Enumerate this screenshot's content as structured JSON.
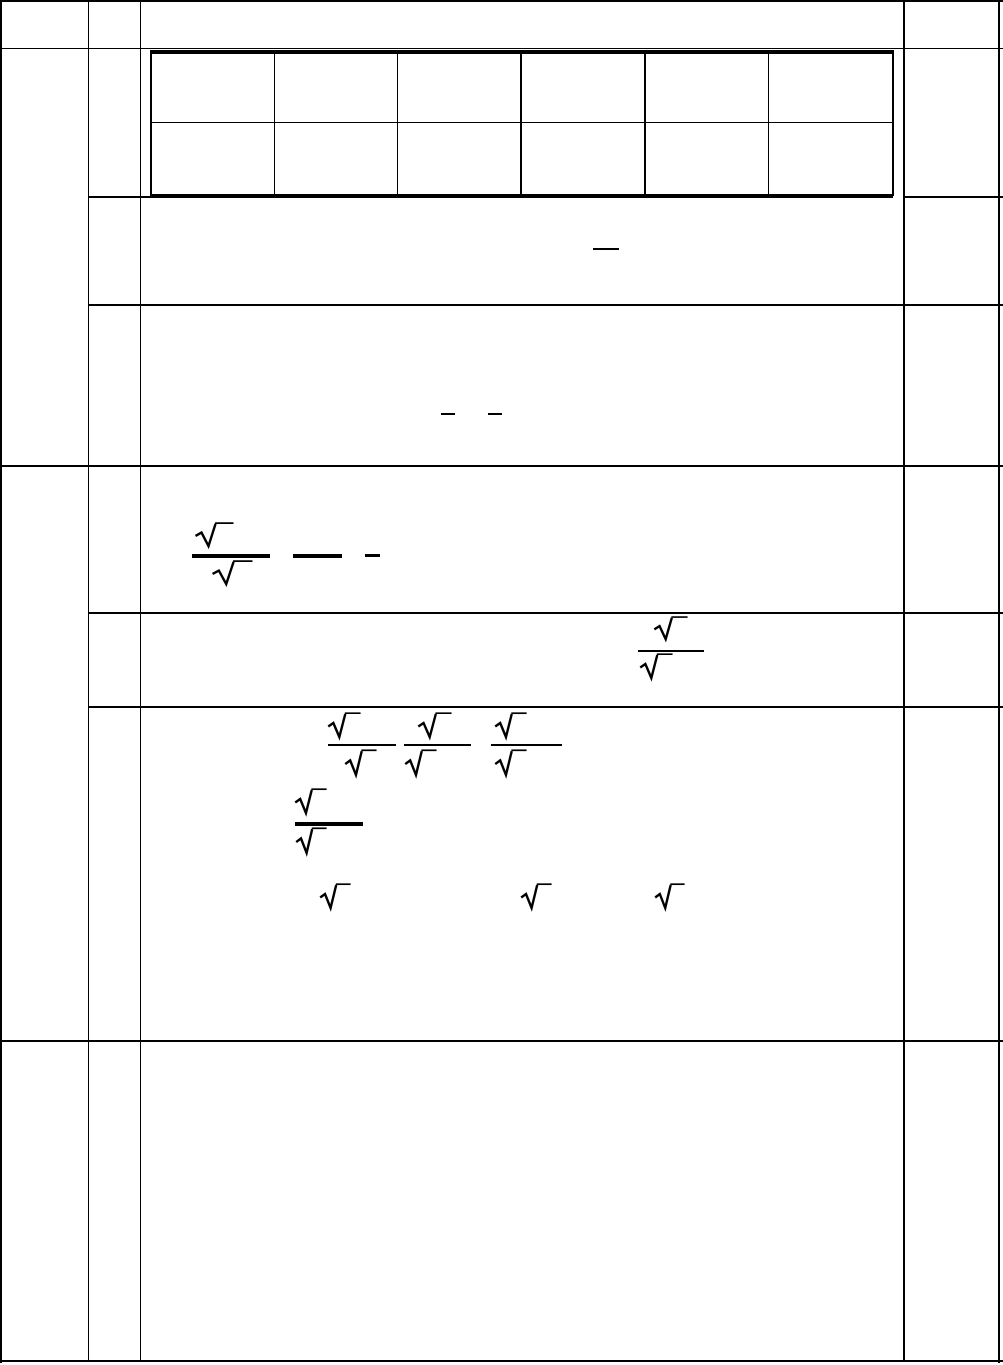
{
  "meta": {
    "description": "scanned blank math worksheet table with stripped symbols",
    "background_color": "#ffffff",
    "ink_color": "#000000",
    "canvas": {
      "width": 1003,
      "height": 1365
    }
  },
  "outer_table": {
    "column_edges_x": [
      0,
      88,
      140,
      904,
      1003
    ],
    "row_edges_y": [
      0,
      47,
      196,
      304,
      465,
      612,
      706,
      1040,
      1363
    ]
  },
  "nested_answer_grid": {
    "x": 150,
    "y": 50,
    "width": 743,
    "height": 147,
    "columns": 6,
    "rows": 2
  },
  "lines": [
    {
      "name": "outer-border-top",
      "x": 0,
      "y": 0,
      "w": 1003,
      "h": 2.2
    },
    {
      "name": "outer-border-bottom",
      "x": 0,
      "y": 1359.5,
      "w": 1003,
      "h": 2.2
    },
    {
      "name": "outer-border-left",
      "x": 0,
      "y": 0,
      "w": 2.2,
      "h": 1363
    },
    {
      "name": "outer-border-right",
      "x": 997.5,
      "y": 0,
      "w": 2.2,
      "h": 1363
    },
    {
      "name": "column-divider-1",
      "x": 87.5,
      "y": 0,
      "w": 1.8,
      "h": 1361
    },
    {
      "name": "column-divider-2",
      "x": 139.5,
      "y": 0,
      "w": 1.8,
      "h": 1361
    },
    {
      "name": "column-divider-3",
      "x": 903,
      "y": 0,
      "w": 1.8,
      "h": 1361
    },
    {
      "name": "row-line-header",
      "x": 0,
      "y": 47.5,
      "w": 1003,
      "h": 1.8
    },
    {
      "name": "row-line-2-left-seg",
      "x": 88,
      "y": 196,
      "w": 63,
      "h": 1.8
    },
    {
      "name": "row-line-2-right-seg",
      "x": 904,
      "y": 196,
      "w": 99,
      "h": 1.8
    },
    {
      "name": "row-line-3",
      "x": 88,
      "y": 304,
      "w": 915,
      "h": 1.8
    },
    {
      "name": "row-line-4",
      "x": 0,
      "y": 465,
      "w": 1003,
      "h": 2
    },
    {
      "name": "row-line-5",
      "x": 88,
      "y": 612,
      "w": 915,
      "h": 1.8
    },
    {
      "name": "row-line-6",
      "x": 88,
      "y": 706,
      "w": 915,
      "h": 1.8
    },
    {
      "name": "row-line-7",
      "x": 0,
      "y": 1040,
      "w": 1003,
      "h": 2
    },
    {
      "name": "nested-grid-border-top",
      "x": 150,
      "y": 50,
      "w": 743,
      "h": 3.5
    },
    {
      "name": "nested-grid-border-bottom",
      "x": 150,
      "y": 194,
      "w": 743,
      "h": 3.5
    },
    {
      "name": "nested-grid-border-left",
      "x": 150,
      "y": 50,
      "w": 2,
      "h": 146
    },
    {
      "name": "nested-grid-border-right",
      "x": 891.5,
      "y": 50,
      "w": 2,
      "h": 146
    },
    {
      "name": "nested-grid-col-line-1",
      "x": 273.5,
      "y": 51,
      "w": 1.8,
      "h": 145
    },
    {
      "name": "nested-grid-col-line-2",
      "x": 396.5,
      "y": 51,
      "w": 1.8,
      "h": 145
    },
    {
      "name": "nested-grid-col-line-3",
      "x": 520,
      "y": 51,
      "w": 1.8,
      "h": 145
    },
    {
      "name": "nested-grid-col-line-4",
      "x": 644,
      "y": 51,
      "w": 1.8,
      "h": 145
    },
    {
      "name": "nested-grid-col-line-5",
      "x": 767.5,
      "y": 51,
      "w": 1.8,
      "h": 145
    },
    {
      "name": "nested-grid-row-line",
      "x": 150,
      "y": 121.5,
      "w": 741.5,
      "h": 1.8
    },
    {
      "name": "fraction-bar-row3",
      "x": 593,
      "y": 247.5,
      "w": 26,
      "h": 2.5
    },
    {
      "name": "minus-dash-row4-a",
      "x": 441,
      "y": 413,
      "w": 14,
      "h": 2
    },
    {
      "name": "minus-dash-row4-b",
      "x": 488,
      "y": 413,
      "w": 14,
      "h": 2
    },
    {
      "name": "fraction-bar-row5",
      "x": 192,
      "y": 554,
      "w": 78,
      "h": 4
    },
    {
      "name": "long-dash-row5",
      "x": 293,
      "y": 554,
      "w": 49,
      "h": 3.5
    },
    {
      "name": "short-dash-row5",
      "x": 365,
      "y": 553.5,
      "w": 15,
      "h": 3
    },
    {
      "name": "fraction-bar-row6",
      "x": 638,
      "y": 649.5,
      "w": 66,
      "h": 2.2
    },
    {
      "name": "fraction-bar-row7-a",
      "x": 328,
      "y": 743.5,
      "w": 68,
      "h": 2.2
    },
    {
      "name": "fraction-bar-row7-b",
      "x": 404,
      "y": 743.5,
      "w": 67,
      "h": 2.2
    },
    {
      "name": "fraction-bar-row7-c",
      "x": 491,
      "y": 743.5,
      "w": 71,
      "h": 2.2
    },
    {
      "name": "fraction-bar-row7-d",
      "x": 295,
      "y": 821.5,
      "w": 68,
      "h": 4
    }
  ],
  "radicals": [
    {
      "name": "radical-row5-numerator",
      "x": 194,
      "y": 521,
      "w": 40,
      "h": 27
    },
    {
      "name": "radical-row5-denominator",
      "x": 211,
      "y": 559,
      "w": 42,
      "h": 27
    },
    {
      "name": "radical-row6-numerator",
      "x": 653,
      "y": 615,
      "w": 35,
      "h": 26
    },
    {
      "name": "radical-row6-denominator",
      "x": 639,
      "y": 652,
      "w": 34,
      "h": 28
    },
    {
      "name": "radical-row7-frac1-numerator",
      "x": 327,
      "y": 711,
      "w": 34,
      "h": 28
    },
    {
      "name": "radical-row7-frac1-denominator",
      "x": 344,
      "y": 748,
      "w": 33,
      "h": 29
    },
    {
      "name": "radical-row7-frac2-numerator",
      "x": 417,
      "y": 711,
      "w": 35,
      "h": 28
    },
    {
      "name": "radical-row7-frac2-denominator",
      "x": 404,
      "y": 748,
      "w": 33,
      "h": 29
    },
    {
      "name": "radical-row7-frac3-numerator",
      "x": 494,
      "y": 711,
      "w": 33,
      "h": 28
    },
    {
      "name": "radical-row7-frac3-denominator",
      "x": 494,
      "y": 748,
      "w": 33,
      "h": 29
    },
    {
      "name": "radical-row7-frac4-numerator",
      "x": 294,
      "y": 787,
      "w": 33,
      "h": 28
    },
    {
      "name": "radical-row7-frac4-denominator",
      "x": 295,
      "y": 826,
      "w": 32,
      "h": 29
    },
    {
      "name": "radical-row7-standalone-1",
      "x": 319,
      "y": 882,
      "w": 32,
      "h": 28
    },
    {
      "name": "radical-row7-standalone-2",
      "x": 520,
      "y": 882,
      "w": 32,
      "h": 28
    },
    {
      "name": "radical-row7-standalone-3",
      "x": 654,
      "y": 882,
      "w": 31,
      "h": 28
    }
  ]
}
